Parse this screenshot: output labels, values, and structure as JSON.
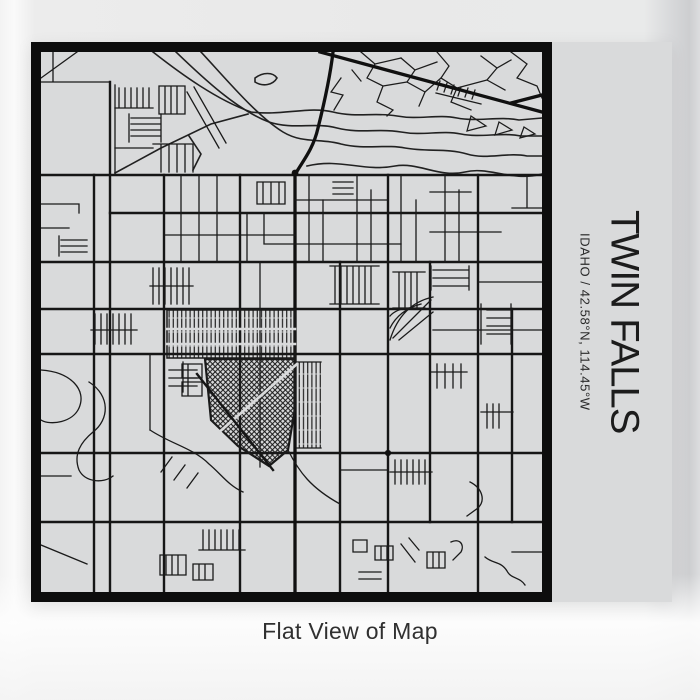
{
  "print": {
    "title": "TWIN FALLS",
    "subtitle": "IDAHO / 42.58°N, 114.45°W"
  },
  "caption": "Flat View of Map",
  "colors": {
    "paper": "#d9dadb",
    "streets": "#1a1a1a",
    "frame": "#0d0d0d",
    "title_text": "#1c1c1c",
    "caption_text": "#303030"
  }
}
